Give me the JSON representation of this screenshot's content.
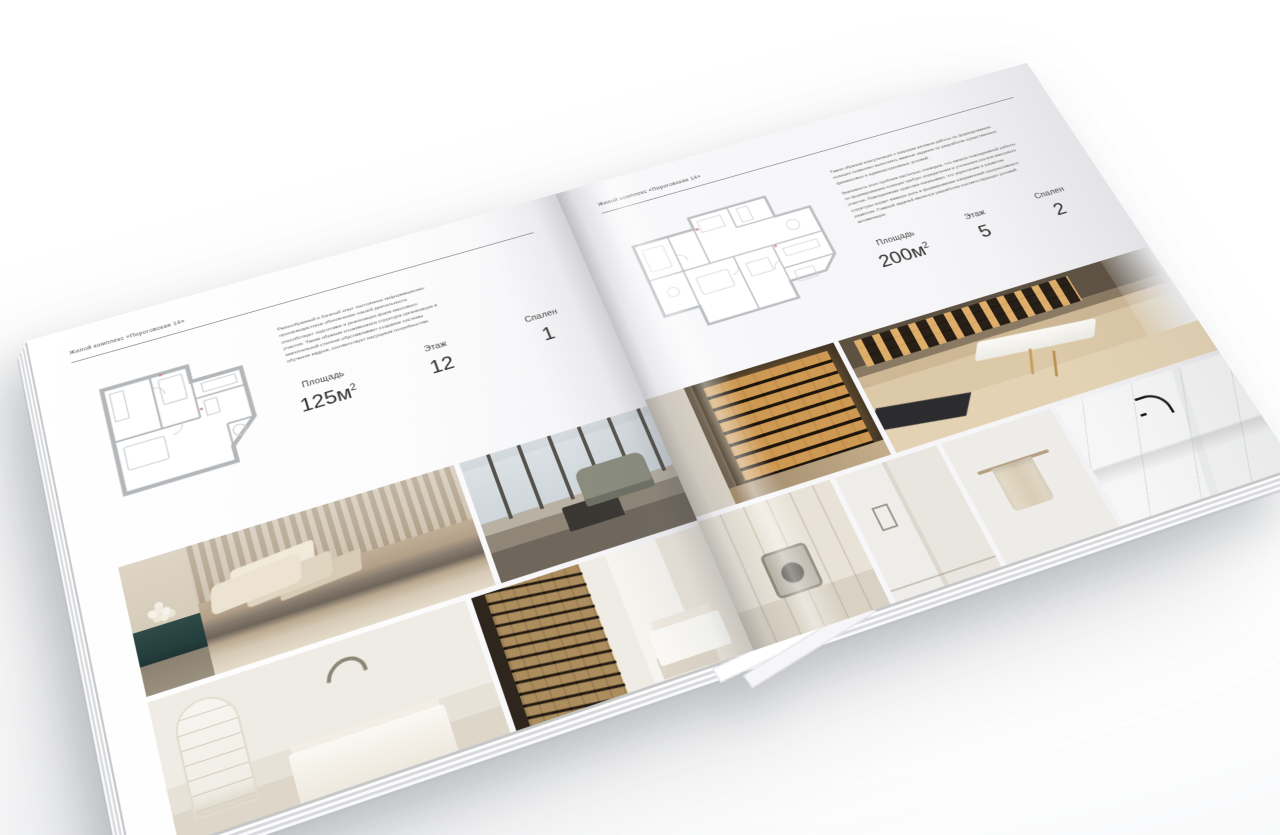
{
  "brochure": {
    "left_page": {
      "header": "Жилой комплекс «Пироговская 14»",
      "description": "Разнообразный и богатый опыт постоянное информационно-пропагандистское обеспечение нашей деятельности способствует подготовке и реализации форм массового участия. Таким образом сложившаяся структура организации в значительной степени обуславливает создание системы обучения кадров, соответствует насущным потребностям.",
      "area_label": "Площадь",
      "area_value": "125м",
      "area_sup": "2",
      "floor_label": "Этаж",
      "floor_value": "12",
      "bedrooms_label": "Спален",
      "bedrooms_value": "1"
    },
    "right_page": {
      "header": "Жилой комплекс «Пироговская 14»",
      "description_1": "Таким образом консультация с широким активом работы по формированию позиции позволяет выполнять важные задания по разработке существенных финансовых и административных условий.",
      "description_2": "Значимость этих проблем настолько очевидна, что начало повседневной работы по формированию позиции требует определения и уточнения систем массового участия. Повседневная практика показывает, что укрепление и развитие структуры играет важную роль в формировании направлений прогрессивного развития. Главной задачей является разработка соответствующих условий активизации.",
      "area_label": "Площадь",
      "area_value": "200м",
      "area_sup": "2",
      "floor_label": "Этаж",
      "floor_value": "5",
      "bedrooms_label": "Спален",
      "bedrooms_value": "2"
    }
  },
  "colors": {
    "paper": "#f7f7f8",
    "text_dark": "#3c3c3c",
    "text_muted": "#605f5b",
    "plan_stroke": "#b4b7ba",
    "teal_cabinet": "#2f4a47",
    "amber_glow": "#d9a35f",
    "wood": "#cdb795",
    "marble": "#f2f3f2"
  }
}
